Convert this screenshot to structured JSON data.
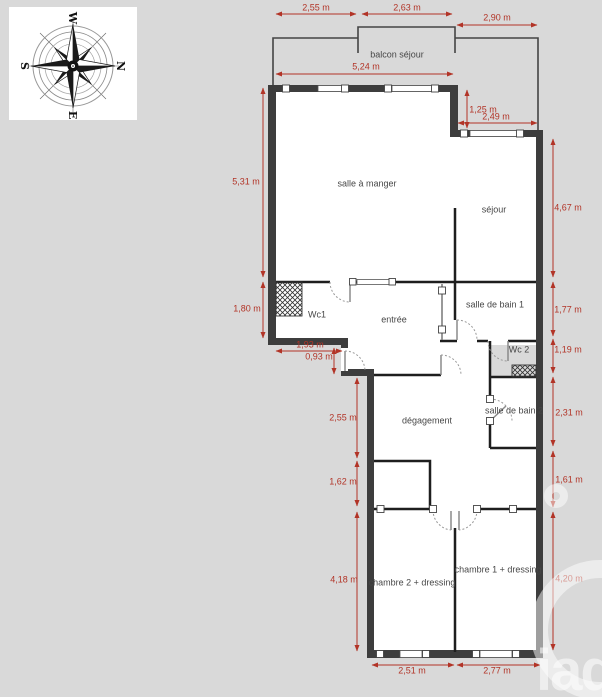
{
  "compass": {
    "top": "W",
    "right": "N",
    "bottom": "E",
    "left": "S"
  },
  "rooms": {
    "balcon": "balcon séjour",
    "salle_a_manger": "salle à manger",
    "sejour": "séjour",
    "wc1": "Wc1",
    "entree": "entrée",
    "sdb1": "salle de bain 1",
    "wc2": "Wc 2",
    "sdb2": "salle de bain 2",
    "degagement": "dégagement",
    "chambre2": "chambre 2 + dressing",
    "chambre1": "chambre 1 + dressing"
  },
  "dims": {
    "balcony_left": "2,55 m",
    "balcony_middle": "2,63 m",
    "balcony_right": "2,90 m",
    "salle_a_manger_width": "5,24 m",
    "sejour_inset": "1,25 m",
    "sejour_width": "2,49 m",
    "salle_a_manger_height": "5,31 m",
    "wc1_height": "1,80 m",
    "wc1_width": "1,93 m",
    "entree_step": "0,93 m",
    "degagement_upper_height": "2,55 m",
    "degagement_lower_height": "1,62 m",
    "chambre2_height": "4,18 m",
    "sejour_height": "4,67 m",
    "sdb1_height": "1,77 m",
    "wc2_height": "1,19 m",
    "sdb2_height": "2,31 m",
    "chambre1_upper_height": "1,61 m",
    "chambre1_height": "4,20 m",
    "chambre2_width": "2,51 m",
    "chambre1_width": "2,77 m"
  },
  "watermark": {
    "text": "iad"
  },
  "colors": {
    "background": "#d9d9d9",
    "wall": "#3d3d3d",
    "dimension_red": "#b23427",
    "floor": "#ffffff"
  }
}
